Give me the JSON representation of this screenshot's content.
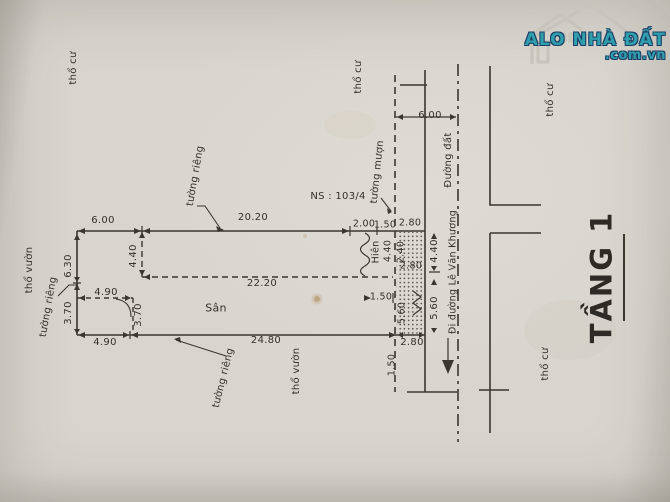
{
  "brand": {
    "name": "ALO NHÀ ĐẤT",
    "domain": ".com.vn",
    "color": "#2f9fae",
    "outline_color": "#1c3f66"
  },
  "plan": {
    "floor_title": "TẦNG 1",
    "parcel_note": "NS : 103/4",
    "yard": "Sân",
    "porch": "Hiên",
    "road_dirt": "Đường đất",
    "road_direction": "Đi đường Lê Văn Khương",
    "land_residential": "thổ cư",
    "land_garden": "thổ vườn",
    "wall_private": "tường riêng",
    "wall_borrowed": "tường mượn"
  },
  "dims": {
    "top_offset": "6.00",
    "top_main": "20.20",
    "top_a": "2.00",
    "top_b": "1.50",
    "top_c": "2.80",
    "left_upper": "6.30",
    "left_lower": "3.70",
    "notch_width": "4.90",
    "notch_height": "3.70",
    "bottom_left": "4.90",
    "bottom_main": "24.80",
    "bottom_strip": "2.80",
    "inner_depth": "4.40",
    "inner_width": "22.20",
    "porch_depth": "4.40",
    "porch_side": "2.40",
    "strip_width": "2.80",
    "porch_gap": "1.50",
    "strip_inner": "5.60",
    "road_width": "6.00",
    "strip_right_upper": "4.40",
    "strip_right_lower": "5.60",
    "below_plot": "1.50"
  }
}
